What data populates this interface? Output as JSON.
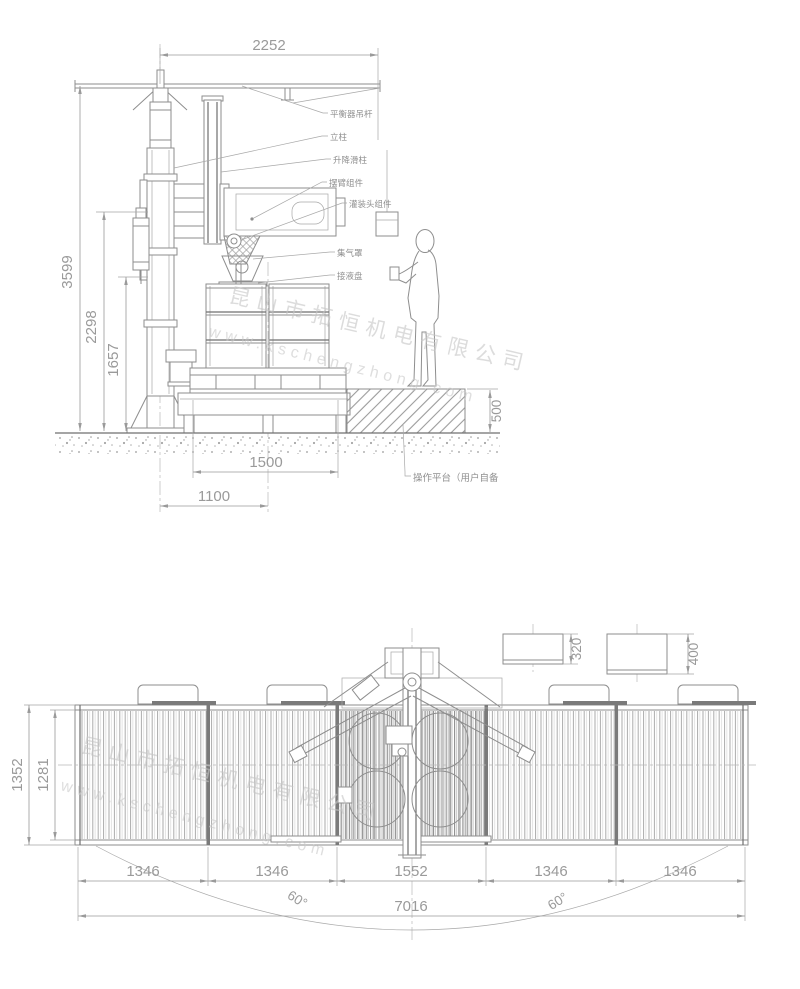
{
  "watermark": {
    "company": "昆山市拓恒机电有限公司",
    "website": "www.kschengzhong.com"
  },
  "elevation": {
    "dims": {
      "beam_span": "2252",
      "total_height": "3599",
      "hook_height": "2298",
      "head_height": "1657",
      "pallet_width": "1500",
      "column_offset": "1100",
      "platform_height": "500"
    },
    "labels": {
      "balancer_rod": "平衡器吊杆",
      "column": "立柱",
      "lift_slide": "升降滑柱",
      "swing_arm": "摆臂组件",
      "filling_head": "灌装头组件",
      "gas_hood": "集气罩",
      "drip_tray": "接液盘",
      "platform": "操作平台（用户自备"
    }
  },
  "plan": {
    "dims": {
      "conveyor_width": "1352",
      "roller_width": "1281",
      "segments": [
        "1346",
        "1346",
        "1552",
        "1346",
        "1346"
      ],
      "total_length": "7016",
      "drum_offset_a": "320",
      "drum_offset_b": "400",
      "swing_left": "60°",
      "swing_right": "60°"
    }
  }
}
